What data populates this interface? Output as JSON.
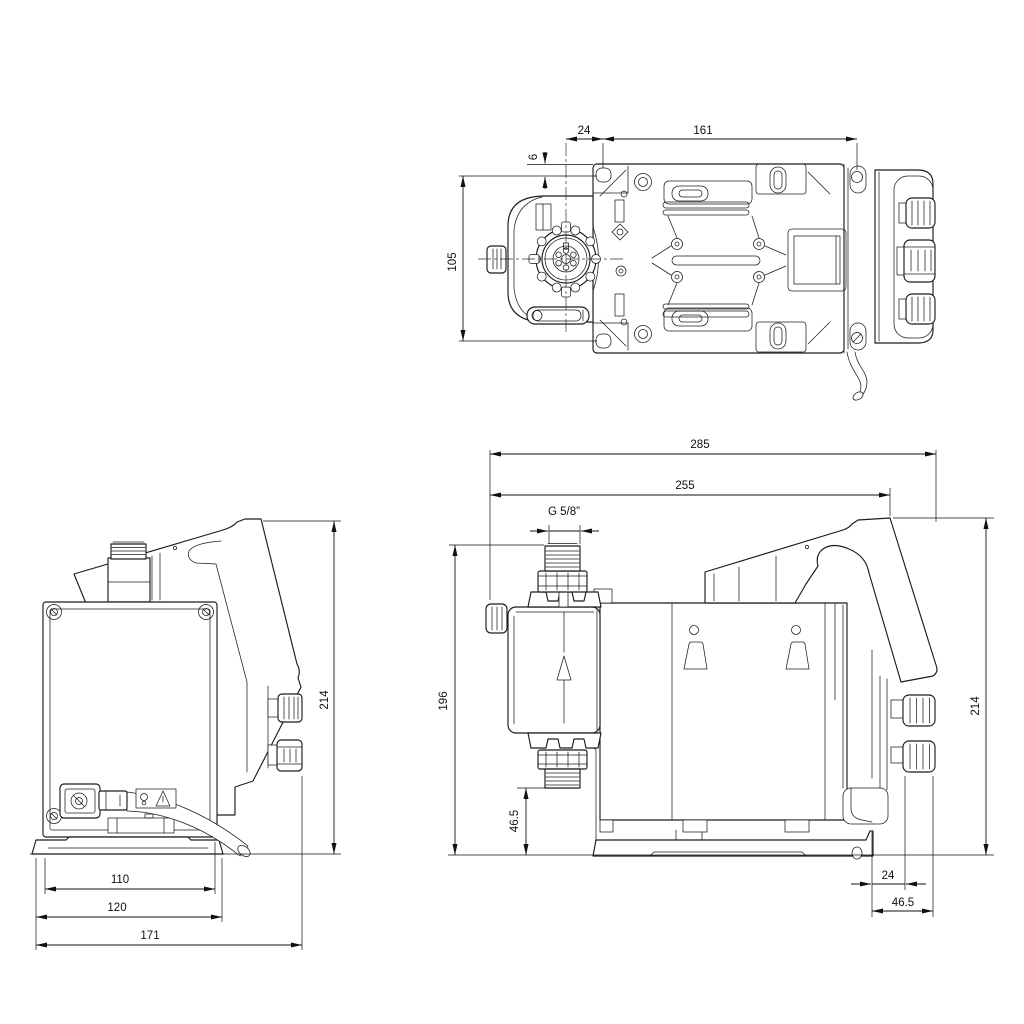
{
  "drawing": {
    "background": "#ffffff",
    "line_color": "#1c1c1c"
  },
  "views": {
    "top": {
      "dims": {
        "d24": "24",
        "d161": "161",
        "d6": "6",
        "d105": "105"
      }
    },
    "front": {
      "dims": {
        "d214": "214",
        "d110": "110",
        "d120": "120",
        "d171": "171"
      }
    },
    "side": {
      "dims": {
        "d285": "285",
        "d255": "255",
        "thread": "G 5/8”",
        "d196": "196",
        "d46_5_left": "46.5",
        "d214": "214",
        "d24": "24",
        "d46_5_bottom": "46.5"
      }
    }
  }
}
